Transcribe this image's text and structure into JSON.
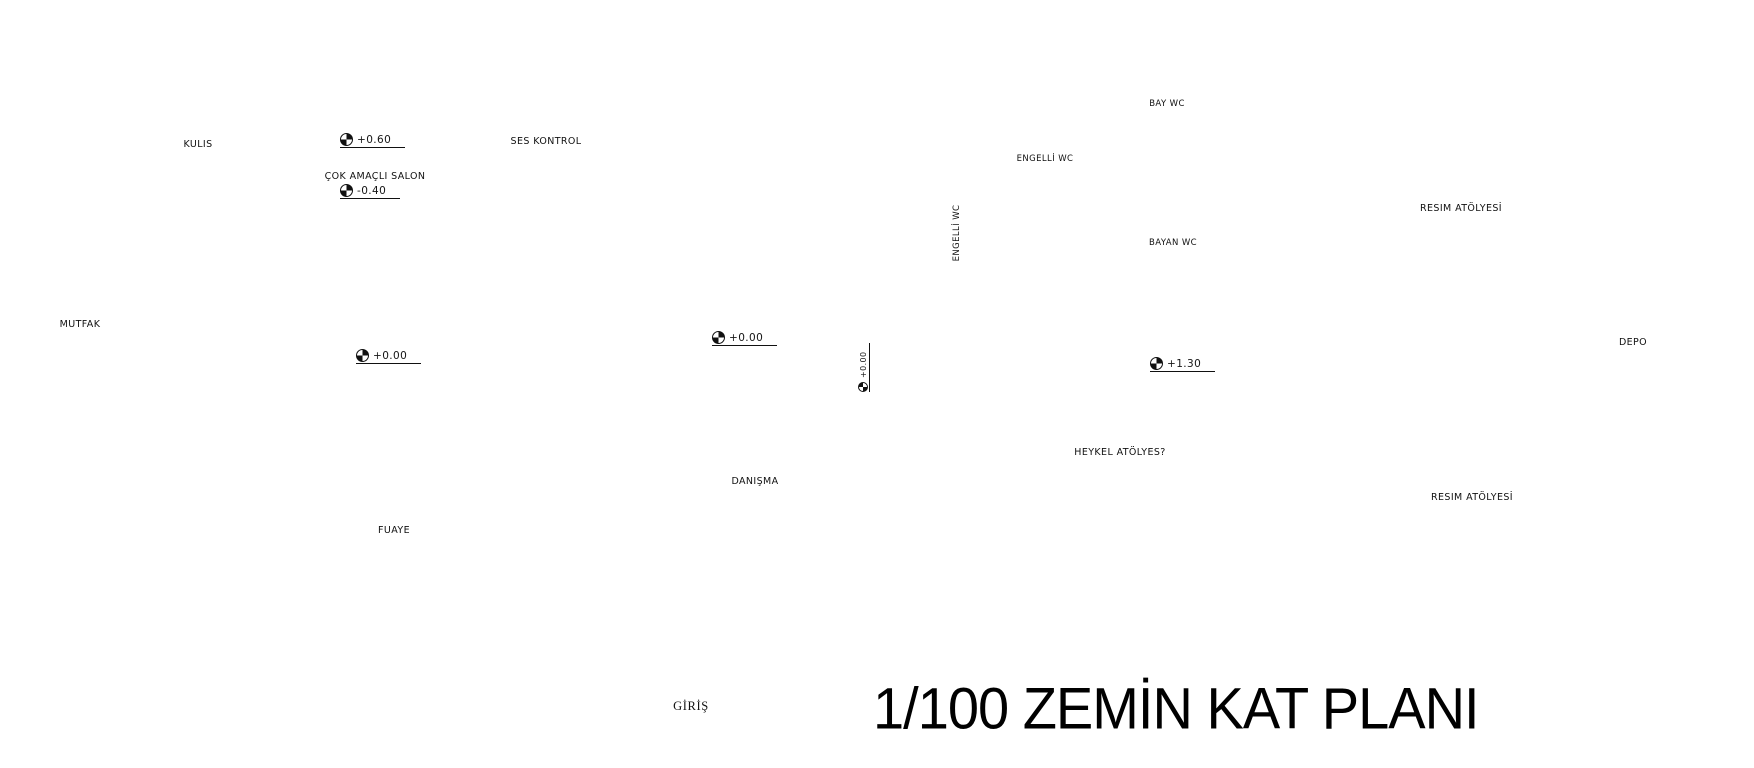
{
  "title": "1/100 ZEMİN KAT PLANI",
  "entrance": {
    "label": "GİRİŞ"
  },
  "rooms": {
    "kulis": "KULIS",
    "cok_amacli_salon": "ÇOK AMAÇLI SALON",
    "ses_kontrol": "SES KONTROL",
    "mutfak": "MUTFAK",
    "fuaye": "FUAYE",
    "danisma": "DANIŞMA",
    "bay_wc": "BAY WC",
    "bayan_wc": "BAYAN WC",
    "engelli_wc_right": "ENGELLİ WC",
    "engelli_wc_lower": "ENGELLİ WC",
    "resim_atolyesi_ust": "RESIM ATÖLYESİ",
    "resim_atolyesi_alt": "RESIM ATÖLYESİ",
    "heykel_atolyesi": "HEYKEL ATÖLYES?",
    "depo": "DEPO"
  },
  "elevations": {
    "sahne": "+0.60",
    "salon": "-0.40",
    "fuaye": "+0.00",
    "merdiven": "+0.00",
    "rampa": "+0.00",
    "atolye_holu": "+1.30"
  },
  "stairs": {
    "main_run_numbers": [
      "1",
      "2",
      "3",
      "4",
      "5",
      "6",
      "7",
      "8",
      "9",
      "10",
      "11",
      "12",
      "13",
      "14",
      "15",
      "16",
      "17"
    ]
  },
  "colors": {
    "ink": "#1c1c1c",
    "paper": "#ffffff"
  }
}
